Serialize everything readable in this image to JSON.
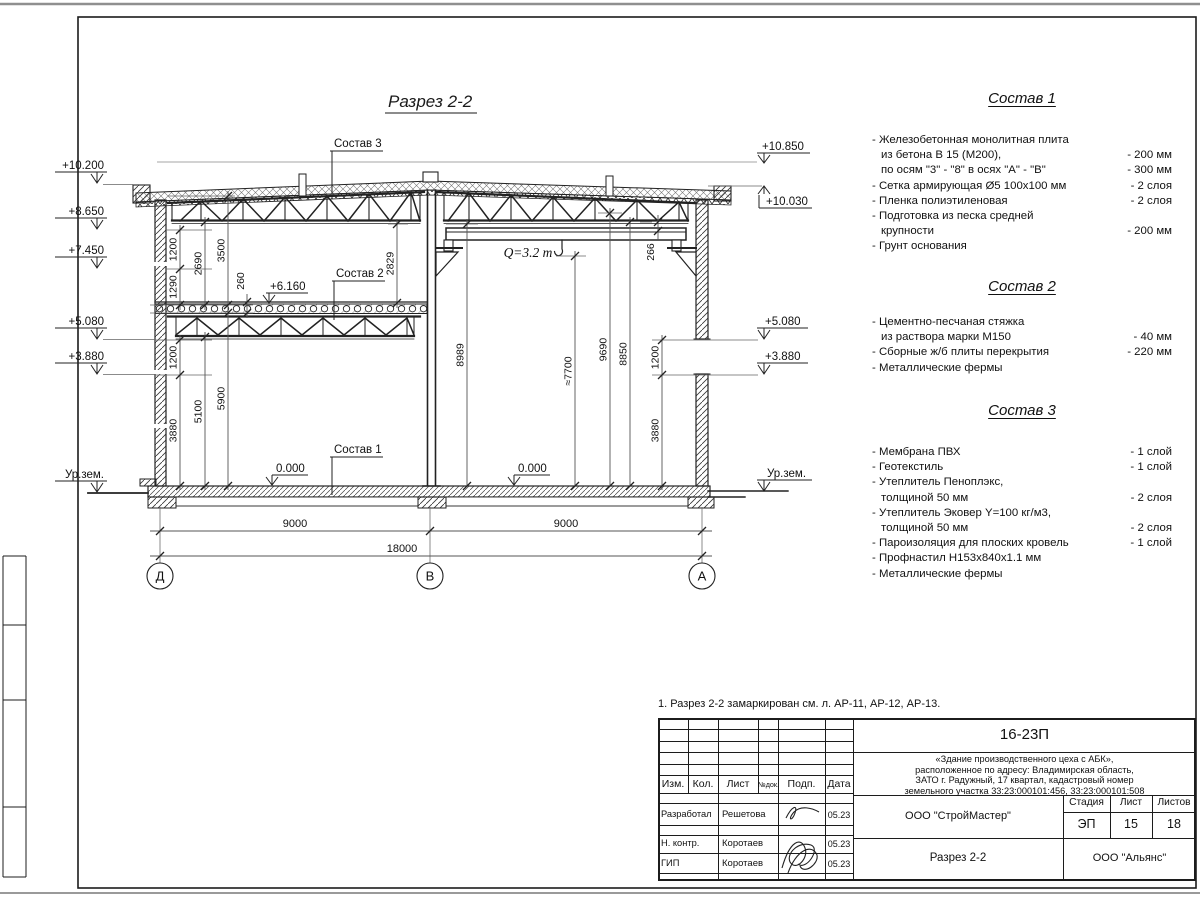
{
  "drawing": {
    "title": "Разрез 2-2",
    "note": "1. Разрез 2-2 замаркирован см. л. АР-11, АР-12, АР-13.",
    "crane": "Q=3.2 т",
    "labels": {
      "sostav1": "Состав 1",
      "sostav2": "Состав 2",
      "sostav3": "Состав 3",
      "plus6160": "+6.160",
      "zero_left": "0.000",
      "zero_right": "0.000"
    },
    "elev_left": {
      "e10200": "+10.200",
      "e8650": "+8.650",
      "e7450": "+7.450",
      "e5080": "+5.080",
      "e3880": "+3.880",
      "ground": "Ур.зем."
    },
    "elev_right": {
      "e10850": "+10.850",
      "e10030": "+10.030",
      "e5080": "+5.080",
      "e3880": "+3.880",
      "ground": "Ур.зем."
    },
    "dims": {
      "v1200a": "1200",
      "v1290": "1290",
      "v2690": "2690",
      "v3500": "3500",
      "v260": "260",
      "v1200b": "1200",
      "v3880a": "3880",
      "v5100": "5100",
      "v5900": "5900",
      "v2829": "2829",
      "v8989": "8989",
      "v7700": "≈7700",
      "v9690": "9690",
      "v8850": "8850",
      "v266": "266",
      "v1200c": "1200",
      "v3880b": "3880",
      "h9000a": "9000",
      "h9000b": "9000",
      "h18000": "18000"
    },
    "axes": {
      "d": "Д",
      "v": "В",
      "a": "А"
    }
  },
  "spec1": {
    "title": "Состав 1",
    "rows": [
      {
        "t": "- Железобетонная  монолитная плита",
        "v": ""
      },
      {
        "t": "из бетона В 15 (М200),",
        "v": "- 200 мм"
      },
      {
        "t": "по осям \"3\" - \"8\" в осях \"А\" - \"В\"",
        "v": "- 300 мм"
      },
      {
        "t": "- Сетка армирующая Ø5 100х100 мм",
        "v": "- 2 слоя"
      },
      {
        "t": "- Пленка полиэтиленовая",
        "v": "- 2 слоя"
      },
      {
        "t": "- Подготовка из песка средней",
        "v": ""
      },
      {
        "t": "крупности",
        "v": "- 200 мм"
      },
      {
        "t": "- Грунт основания",
        "v": ""
      }
    ]
  },
  "spec2": {
    "title": "Состав 2",
    "rows": [
      {
        "t": "- Цементно-песчаная стяжка",
        "v": ""
      },
      {
        "t": "из раствора марки М150",
        "v": "- 40 мм"
      },
      {
        "t": "- Сборные ж/б плиты перекрытия",
        "v": "- 220 мм"
      },
      {
        "t": "- Металлические фермы",
        "v": ""
      }
    ]
  },
  "spec3": {
    "title": "Состав 3",
    "rows": [
      {
        "t": "- Мембрана ПВХ",
        "v": "- 1 слой"
      },
      {
        "t": "- Геотекстиль",
        "v": "- 1 слой"
      },
      {
        "t": "- Утеплитель Пеноплэкс,",
        "v": ""
      },
      {
        "t": "толщиной 50 мм",
        "v": "- 2 слоя"
      },
      {
        "t": "- Утеплитель Эковер Y=100 кг/м3,",
        "v": ""
      },
      {
        "t": "толщиной 50 мм",
        "v": "- 2 слоя"
      },
      {
        "t": "- Пароизоляция для плоских кровель",
        "v": "- 1 слой"
      },
      {
        "t": "- Профнастил Н153х840х1.1 мм",
        "v": ""
      },
      {
        "t": "- Металлические фермы",
        "v": ""
      }
    ]
  },
  "titleblock": {
    "code": "16-23П",
    "desc1": "«Здание производственного цеха с АБК»,",
    "desc2": "расположенное по адресу: Владимирская область,",
    "desc3": "ЗАТО г. Радужный, 17 квартал, кадастровый номер",
    "desc4": "земельного участка 33:23:000101:456, 33:23:000101:508",
    "col_izm": "Изм.",
    "col_kol": "Кол.",
    "col_list": "Лист",
    "col_ndok": "№док.",
    "col_podp": "Подп.",
    "col_data": "Дата",
    "row1_role": "Разработал",
    "row1_name": "Решетова",
    "row1_date": "05.23",
    "row2_role": "Н. контр.",
    "row2_name": "Коротаев",
    "row2_date": "05.23",
    "row3_role": "ГИП",
    "row3_name": "Коротаев",
    "row3_date": "05.23",
    "org": "ООО \"СтройМастер\"",
    "stage_h": "Стадия",
    "sheet_h": "Лист",
    "sheets_h": "Листов",
    "stage": "ЭП",
    "sheet": "15",
    "sheets": "18",
    "section": "Разрез 2-2",
    "org2": "ООО \"Альянс\""
  }
}
